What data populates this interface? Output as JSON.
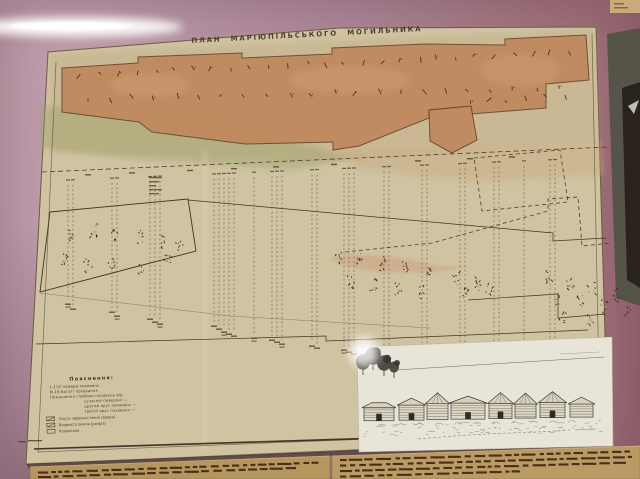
{
  "exhibit": {
    "title": "ПЛАН МАРІЮПІЛЬСЬКОГО МОГИЛЬНИКА",
    "legend": {
      "heading": "Пояснення:",
      "entries": [
        {
          "text": "1-122  номери поховань",
          "indent": 0
        },
        {
          "text": "М-16  багаті поховання",
          "indent": 0
        },
        {
          "text": "Позначення глибини поховань від",
          "indent": 0
        },
        {
          "text": "сучасної поверхні —",
          "indent": 1
        },
        {
          "text": "другий ярус поховань —",
          "indent": 1
        },
        {
          "text": "третій ярус поховань —",
          "indent": 1
        }
      ],
      "swatches": [
        "Смуга червоної землі (вохра)",
        "Вохриста земля (розріз)",
        "Розкопано"
      ]
    },
    "plan": {
      "grave_tick_rows": [
        {
          "from": [
            80,
            75
          ],
          "to": [
            570,
            52
          ],
          "count": 27
        },
        {
          "from": [
            88,
            99
          ],
          "to": [
            558,
            88
          ],
          "count": 22
        },
        {
          "from": [
            468,
            103
          ],
          "to": [
            566,
            96
          ],
          "count": 6
        }
      ],
      "scale_mark_xs": [
        88,
        132,
        190,
        234,
        276,
        334,
        418,
        470,
        512
      ],
      "section_lines": [
        [
          68,
          300
        ],
        [
          73,
          305
        ],
        [
          112,
          308
        ],
        [
          117,
          312
        ],
        [
          150,
          315
        ],
        [
          155,
          318
        ],
        [
          160,
          320
        ],
        [
          214,
          322
        ],
        [
          219,
          325
        ],
        [
          224,
          328
        ],
        [
          229,
          330
        ],
        [
          234,
          332
        ],
        [
          254,
          334
        ],
        [
          272,
          336
        ],
        [
          277,
          338
        ],
        [
          282,
          340
        ],
        [
          312,
          342
        ],
        [
          317,
          344
        ],
        [
          344,
          346
        ],
        [
          349,
          348
        ],
        [
          354,
          350
        ],
        [
          384,
          350
        ],
        [
          389,
          352
        ],
        [
          422,
          352
        ],
        [
          427,
          354
        ],
        [
          460,
          354
        ],
        [
          465,
          356
        ],
        [
          494,
          354
        ],
        [
          499,
          356
        ],
        [
          524,
          352
        ],
        [
          550,
          350
        ],
        [
          555,
          352
        ]
      ],
      "figure_clusters": {
        "left": [
          [
            72,
            236
          ],
          [
            94,
            230
          ],
          [
            114,
            234
          ],
          [
            140,
            238
          ],
          [
            162,
            242
          ],
          [
            64,
            260
          ],
          [
            88,
            264
          ],
          [
            112,
            266
          ],
          [
            142,
            268
          ],
          [
            168,
            257
          ],
          [
            180,
            246
          ]
        ],
        "center": [
          [
            338,
            256
          ],
          [
            360,
            260
          ],
          [
            382,
            264
          ],
          [
            406,
            268
          ],
          [
            428,
            272
          ],
          [
            350,
            282
          ],
          [
            374,
            286
          ],
          [
            398,
            289
          ],
          [
            420,
            292
          ]
        ],
        "center_right": [
          [
            456,
            280
          ],
          [
            478,
            284
          ],
          [
            466,
            294
          ],
          [
            490,
            290
          ]
        ],
        "right": [
          [
            548,
            278
          ],
          [
            570,
            284
          ],
          [
            592,
            288
          ],
          [
            556,
            298
          ],
          [
            580,
            302
          ],
          [
            604,
            306
          ],
          [
            616,
            296
          ],
          [
            628,
            310
          ],
          [
            562,
            316
          ],
          [
            590,
            318
          ]
        ]
      }
    },
    "inset": {
      "houses": [
        {
          "x": 364,
          "w": 30,
          "h": 13,
          "roof": "low",
          "door": true
        },
        {
          "x": 399,
          "w": 25,
          "h": 15,
          "roof": "gable",
          "door": true
        },
        {
          "x": 427,
          "w": 21,
          "h": 16,
          "roof": "pyramid",
          "door": false
        },
        {
          "x": 451,
          "w": 34,
          "h": 16,
          "roof": "gable",
          "door": true
        },
        {
          "x": 489,
          "w": 23,
          "h": 15,
          "roof": "pyramid",
          "door": true
        },
        {
          "x": 515,
          "w": 21,
          "h": 14,
          "roof": "pyramid",
          "door": false
        },
        {
          "x": 540,
          "w": 25,
          "h": 15,
          "roof": "pyramid",
          "door": true
        },
        {
          "x": 570,
          "w": 23,
          "h": 13,
          "roof": "gable",
          "door": false
        }
      ],
      "trees": [
        [
          363,
          362,
          7
        ],
        [
          373,
          356,
          8
        ],
        [
          384,
          363,
          7
        ],
        [
          394,
          367,
          5
        ]
      ]
    },
    "caption_strips": {
      "left_rows": [
        {
          "x0": 38,
          "x1": 322,
          "y": 471.5,
          "slope": 0.036
        },
        {
          "x0": 38,
          "x1": 298,
          "y": 476,
          "slope": 0.036
        }
      ],
      "right_rows": [
        {
          "x0": 340,
          "x1": 630,
          "y": 459,
          "slope": 0.03
        },
        {
          "x0": 340,
          "x1": 632,
          "y": 464.5,
          "slope": 0.03
        },
        {
          "x0": 340,
          "x1": 626,
          "y": 470,
          "slope": 0.03
        },
        {
          "x0": 340,
          "x1": 520,
          "y": 475.5,
          "slope": 0.03
        }
      ]
    }
  },
  "colors": {
    "wall": "#b48fa0",
    "wall_right": "#a1707e",
    "paper": "#cfc3a2",
    "trench_fill": "#c0885c",
    "ink": "#3a2d1e",
    "ink_dark": "#2c2113",
    "inset_paper": "#e8e4d7",
    "strip": "#b5965f",
    "strip_right": "#ba9b65",
    "strip_text": "#3f250e",
    "case_gray": "#565349",
    "case_dark": "#2a231c",
    "glare": "#ffffff"
  }
}
